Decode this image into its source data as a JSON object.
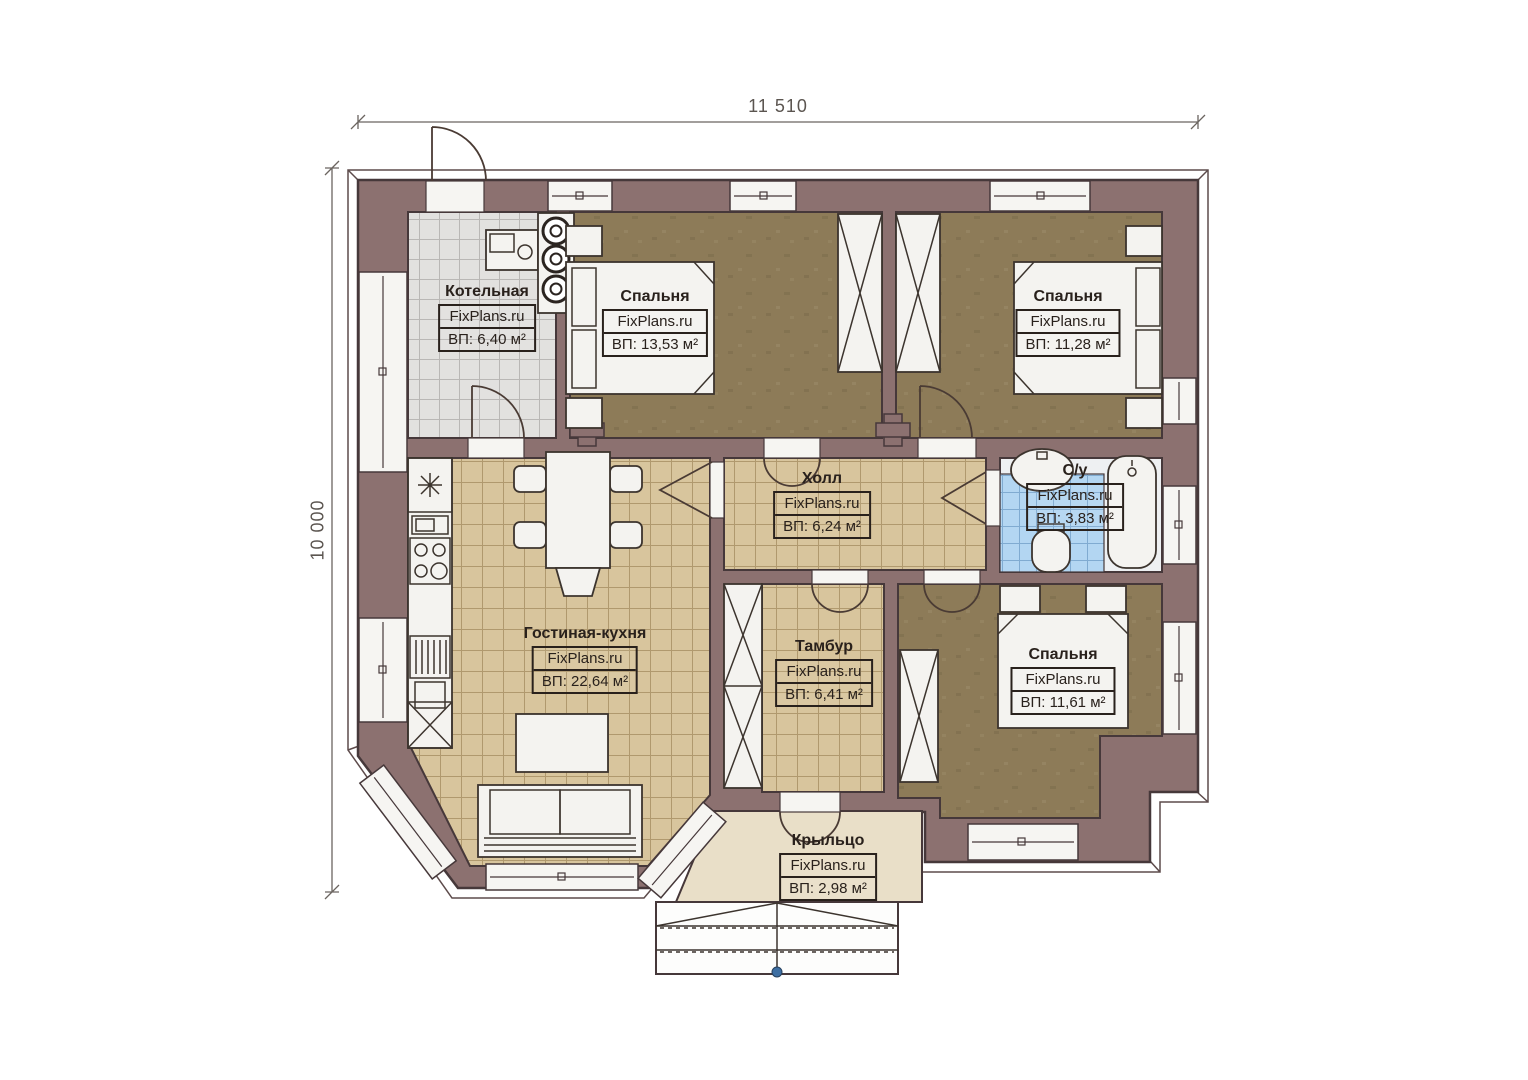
{
  "dimensions": {
    "width_label": "11 510",
    "height_label": "10 000"
  },
  "rooms": [
    {
      "id": "boiler",
      "name": "Котельная",
      "site": "FixPlans.ru",
      "area": "ВП: 6,40 м²"
    },
    {
      "id": "bedroom-1",
      "name": "Спальня",
      "site": "FixPlans.ru",
      "area": "ВП: 13,53 м²"
    },
    {
      "id": "bedroom-2",
      "name": "Спальня",
      "site": "FixPlans.ru",
      "area": "ВП: 11,28 м²"
    },
    {
      "id": "hall",
      "name": "Холл",
      "site": "FixPlans.ru",
      "area": "ВП: 6,24 м²"
    },
    {
      "id": "bathroom",
      "name": "С/у",
      "site": "FixPlans.ru",
      "area": "ВП: 3,83 м²"
    },
    {
      "id": "living-kitchen",
      "name": "Гостиная-кухня",
      "site": "FixPlans.ru",
      "area": "ВП: 22,64 м²"
    },
    {
      "id": "vestibule",
      "name": "Тамбур",
      "site": "FixPlans.ru",
      "area": "ВП: 6,41 м²"
    },
    {
      "id": "bedroom-3",
      "name": "Спальня",
      "site": "FixPlans.ru",
      "area": "ВП: 11,61 м²"
    },
    {
      "id": "porch",
      "name": "Крыльцо",
      "site": "FixPlans.ru",
      "area": "ВП: 2,98 м²"
    }
  ],
  "colors": {
    "wall": "#8c7170",
    "wall_line": "#46383a",
    "floor_wood": "#8d7b58",
    "tile_tan": "#d8c59d",
    "tile_tan_line": "#a68e62",
    "tile_gray": "#e2e1df",
    "tile_gray_line": "#b5b3b0",
    "tile_blue": "#b3d6f2",
    "tile_blue_line": "#7aa6cd",
    "porch": "#e9dfc8",
    "furniture": "#f4f3f0",
    "furniture_line": "#3c342e",
    "text": "#29211c",
    "dim_text": "#5b5550",
    "accent_dot": "#3e6fa3",
    "paper": "#ffffff"
  }
}
